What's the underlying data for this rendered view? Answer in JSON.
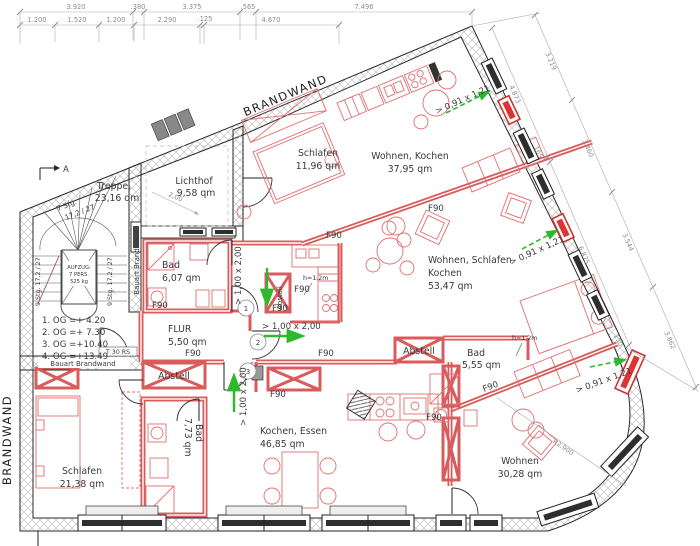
{
  "labels": {
    "brandwand": "BRANDWAND",
    "bauart": "Bauart Brandwand",
    "t30": "T 30 RS",
    "f90": "F90",
    "section": "A"
  },
  "stair": {
    "name": "Treppe,",
    "area": "23,16 qm",
    "flight7a": "7 Stg.",
    "flight7b": "17,2 / 27",
    "flight9": "9 Stg. 17,2 / 27",
    "lift1": "AUFZUG:",
    "lift2": "7 PERS.",
    "lift3": "525 kg"
  },
  "levels": [
    "1. OG =+  4.20",
    "2. OG =+  7.30",
    "3. OG =+10.40",
    "4. OG =+13.49"
  ],
  "rooms": {
    "lichthof": {
      "name": "Lichthof",
      "area": "9,58 qm"
    },
    "schlafen_a": {
      "name": "Schlafen",
      "area": "11,96 qm"
    },
    "wohnen_a": {
      "name": "Wohnen, Kochen",
      "area": "37,95 qm"
    },
    "studio": {
      "l1": "Wohnen, Schlafen",
      "l2": "Kochen",
      "area": "53,47 qm"
    },
    "bad_a": {
      "name": "Bad",
      "area": "6,07 qm"
    },
    "flur": {
      "name": "FLUR",
      "area": "5,50 qm"
    },
    "bad_b": {
      "name": "Bad",
      "area": "5,55 qm"
    },
    "bad_c": {
      "name": "Bad",
      "area": "7,73 qm"
    },
    "schlafen_c": {
      "name": "Schlafen",
      "area": "21,38 qm"
    },
    "kochen_c": {
      "name": "Kochen, Essen",
      "area": "46,85 qm"
    },
    "wohnen_c": {
      "name": "Wohnen",
      "area": "30,28 qm"
    },
    "abstell": "Abstell"
  },
  "openings": {
    "door_label": "> 1,00 x 2,00",
    "window_label": "> 0,91 x 1,21",
    "d1": "1",
    "d2": "2",
    "d3": "3",
    "parapet": "h=1.2m"
  },
  "dims": {
    "top1": [
      "3.920",
      ".380",
      "3.375",
      ".565",
      "7.496"
    ],
    "top2": [
      "1.200",
      "1.520",
      "1.200",
      "2.290",
      ".125",
      "4.670"
    ],
    "right_outer": [
      "3.219",
      "3.460",
      "3.544",
      "3.862"
    ],
    "right_inner": [
      "4.873",
      ".165",
      "6.875",
      ".150"
    ],
    "radius": "R2.900",
    "lichthof": "2,00"
  },
  "colors": {
    "wall_red": "#d95c5c",
    "furniture_red": "#e07070",
    "green": "#2db82d",
    "hatch": "#b5b5b5",
    "dim_text": "#8a8a8a",
    "text": "#3a3a3a"
  }
}
